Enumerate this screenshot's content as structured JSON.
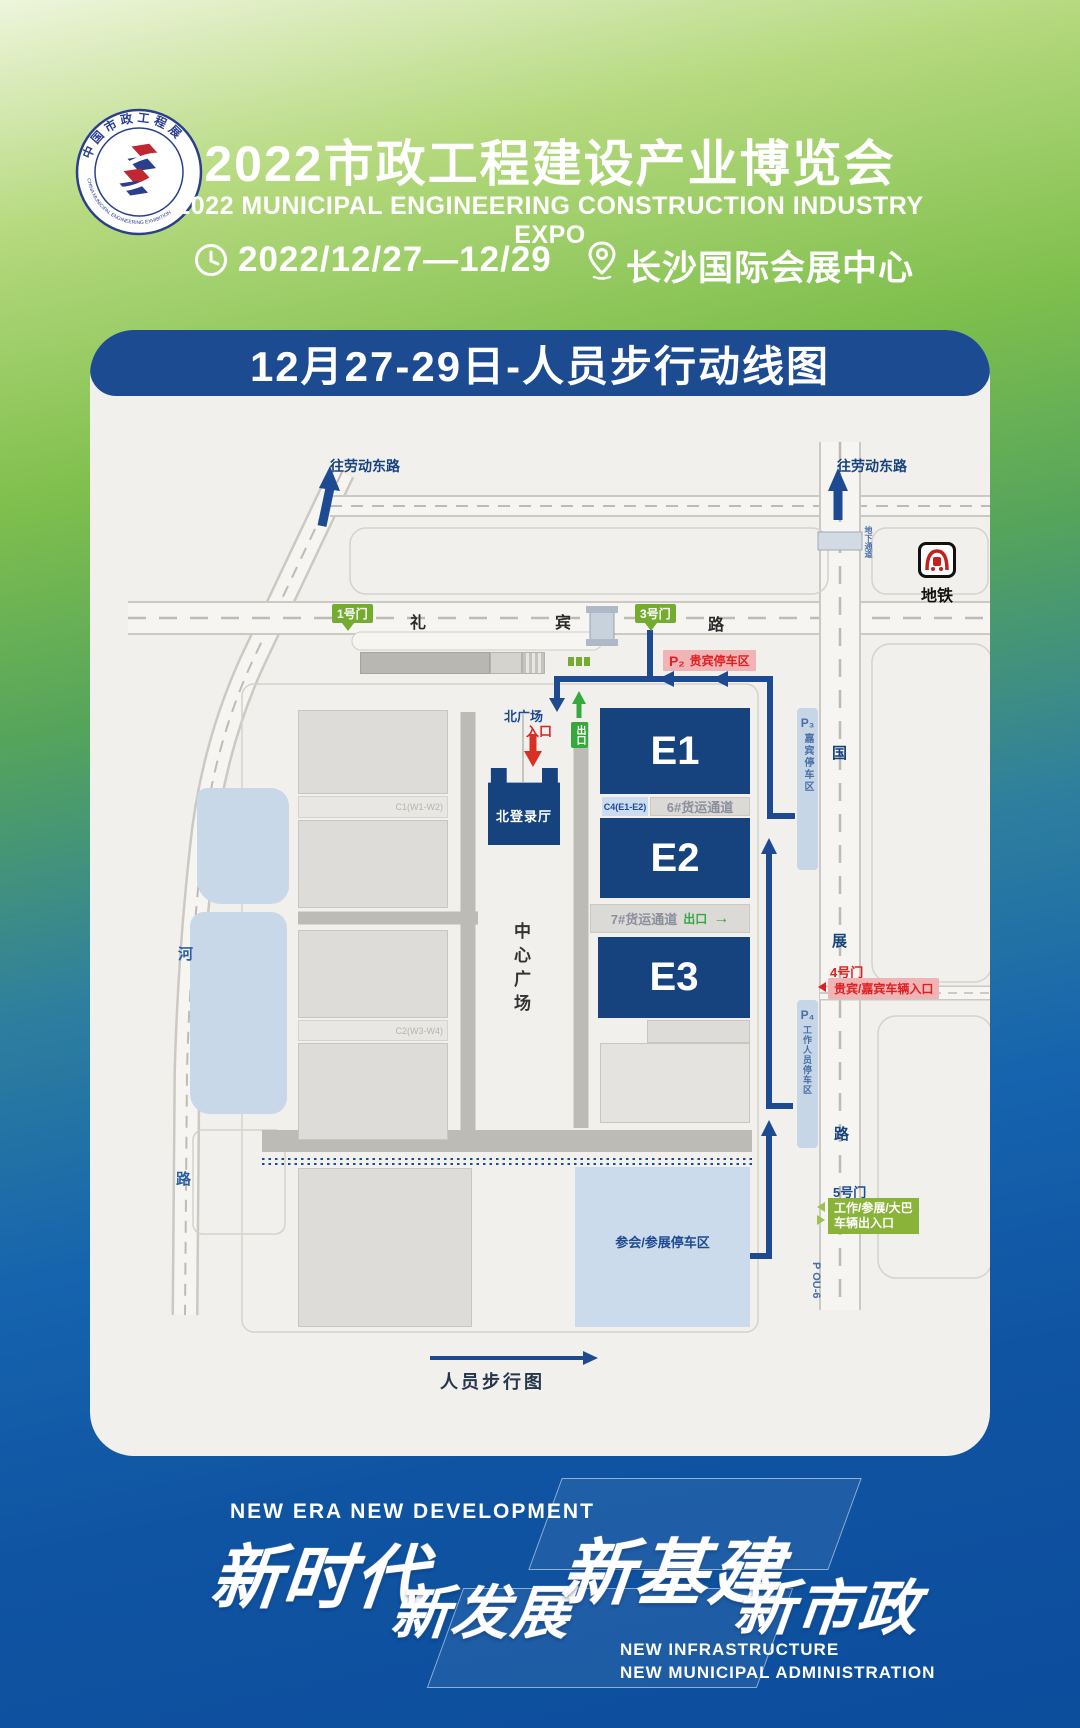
{
  "header": {
    "logo": {
      "top_text": "中国市政工程展",
      "bottom_text": "CHINA MUNICIPAL ENGINEERING EXHIBITION"
    },
    "title": "2022市政工程建设产业博览会",
    "subtitle": "2022 MUNICIPAL ENGINEERING CONSTRUCTION INDUSTRY EXPO",
    "date": "2022/12/27—12/29",
    "venue": "长沙国际会展中心"
  },
  "map_card": {
    "title": "12月27-29日-人员步行动线图",
    "roads": {
      "laodong_left": "往劳动东路",
      "laodong_right": "往劳动东路",
      "libin": [
        "礼",
        "宾",
        "路"
      ],
      "guozhan": [
        "国",
        "展",
        "路"
      ],
      "he": [
        "河",
        "路"
      ],
      "underpass": "地下通道"
    },
    "gates": {
      "gate1": "1号门",
      "gate3": "3号门",
      "gate4": "4号门",
      "gate4_desc": "贵宾/嘉宾车辆入口",
      "gate5": "5号门",
      "gate5_desc_line1": "工作/参展/大巴",
      "gate5_desc_line2": "车辆出入口"
    },
    "halls": {
      "e1": "E1",
      "e2": "E2",
      "e3": "E3",
      "north_hall": "北登录厅",
      "c4": "C4(E1-E2)",
      "c1": "C1(W1-W2)",
      "c2": "C2(W3-W4)",
      "corridor6": "6#货运通道",
      "corridor7": "7#货运通道"
    },
    "areas": {
      "north_plaza": "北广场",
      "entrance": "入口",
      "exit": "出口",
      "exit2": "出口",
      "center_plaza": "中心广场",
      "p2_num": "P₂",
      "p2": "贵宾停车区",
      "p3_num": "P₃",
      "p3": "嘉宾停车区",
      "p4_num": "P₄",
      "p4": "工作人员停车区",
      "attendee_parking": "参会/参展停车区",
      "pou6": "P OU-6"
    },
    "metro": {
      "label": "地铁"
    },
    "legend": {
      "label": "人员步行图"
    }
  },
  "footer": {
    "tagline_en": "NEW ERA  NEW DEVELOPMENT",
    "slogan1": "新时代",
    "slogan2": "新发展",
    "slogan3": "新基建",
    "slogan4": "新市政",
    "tagline2_line1": "NEW INFRASTRUCTURE",
    "tagline2_line2": "NEW MUNICIPAL ADMINISTRATION"
  }
}
